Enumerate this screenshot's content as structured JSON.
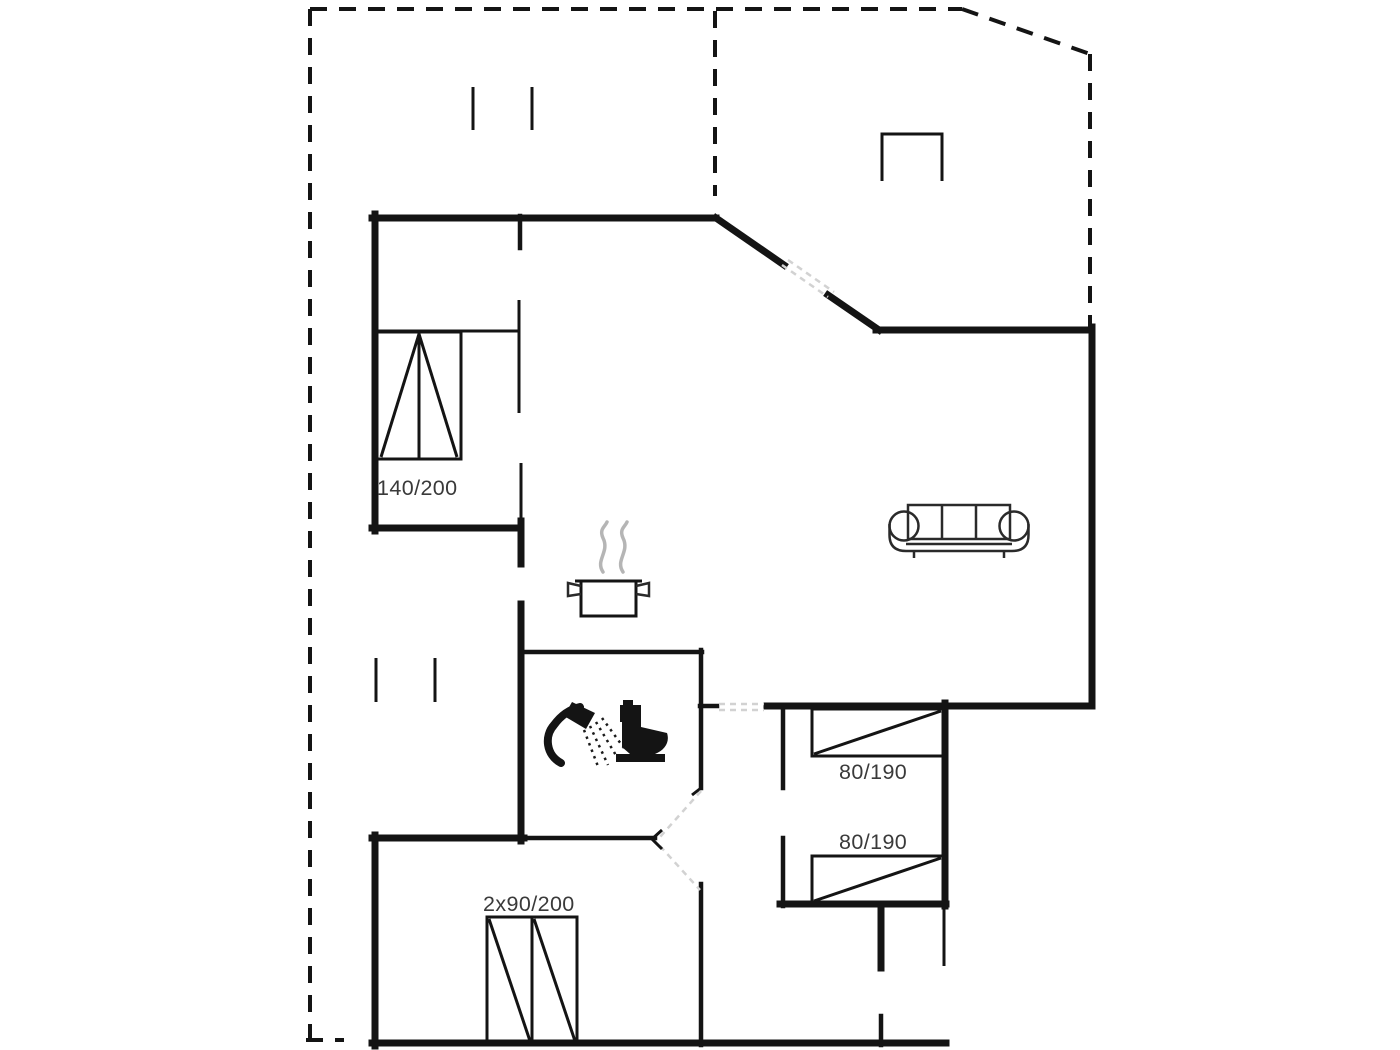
{
  "page": {
    "type": "holiday-home-floor-plan",
    "background": "#ffffff"
  },
  "colors": {
    "wall": "#141414",
    "label": "#3a3a3a",
    "steam": "#b5b5b5",
    "door_swing": "#d2d2d2"
  },
  "labels": {
    "master_bed": "140/200",
    "single_bed_1": "80/190",
    "single_bed_2": "80/190",
    "double_bed": "2x90/200"
  },
  "icons": [
    {
      "name": "double-bed-icon",
      "meaning": "double bed 140/200"
    },
    {
      "name": "single-bed-icon",
      "meaning": "single bed 80/190 (upper room)"
    },
    {
      "name": "single-bed-icon",
      "meaning": "single bed 80/190 (lower room)"
    },
    {
      "name": "twin-bed-icon",
      "meaning": "two single beds 2x90/200"
    },
    {
      "name": "sofa-icon",
      "meaning": "living room sofa"
    },
    {
      "name": "cooking-pot-icon",
      "meaning": "kitchen / stove"
    },
    {
      "name": "shower-icon",
      "meaning": "bathroom shower"
    },
    {
      "name": "toilet-icon",
      "meaning": "bathroom toilet"
    },
    {
      "name": "grill-icon",
      "meaning": "terrace fixture"
    }
  ]
}
